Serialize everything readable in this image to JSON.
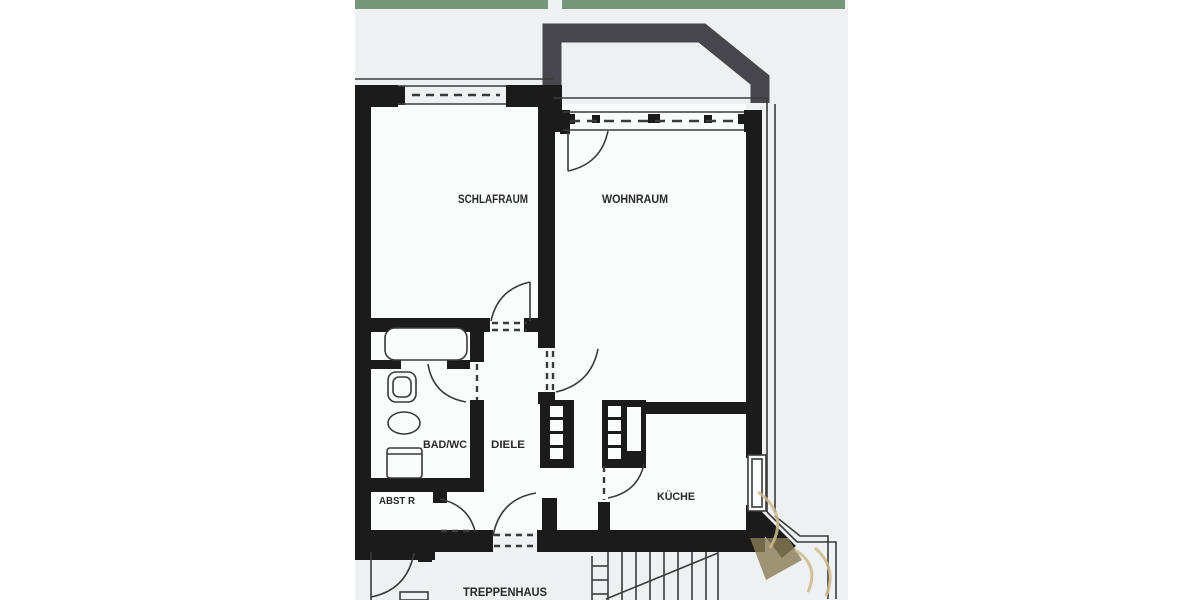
{
  "labels": {
    "schlafraum": "SCHLAFRAUM",
    "wohnraum": "WOHNRAUM",
    "bad_wc": "BAD/WC",
    "diele": "DIELE",
    "abstr": "ABST R",
    "kueche": "KÜCHE",
    "treppenhaus": "TREPPENHAUS"
  },
  "colors": {
    "wall": "#1b1b1b",
    "line": "#3a3a3a",
    "balcony": "#46464c",
    "paper": "#eef0f2",
    "paper_light": "#fafbfb",
    "margin": "#ffffff",
    "green": "#76967a",
    "watermark": "#8a7c55",
    "watermark_light": "#cdbb8e",
    "text": "#2a2a2a"
  }
}
